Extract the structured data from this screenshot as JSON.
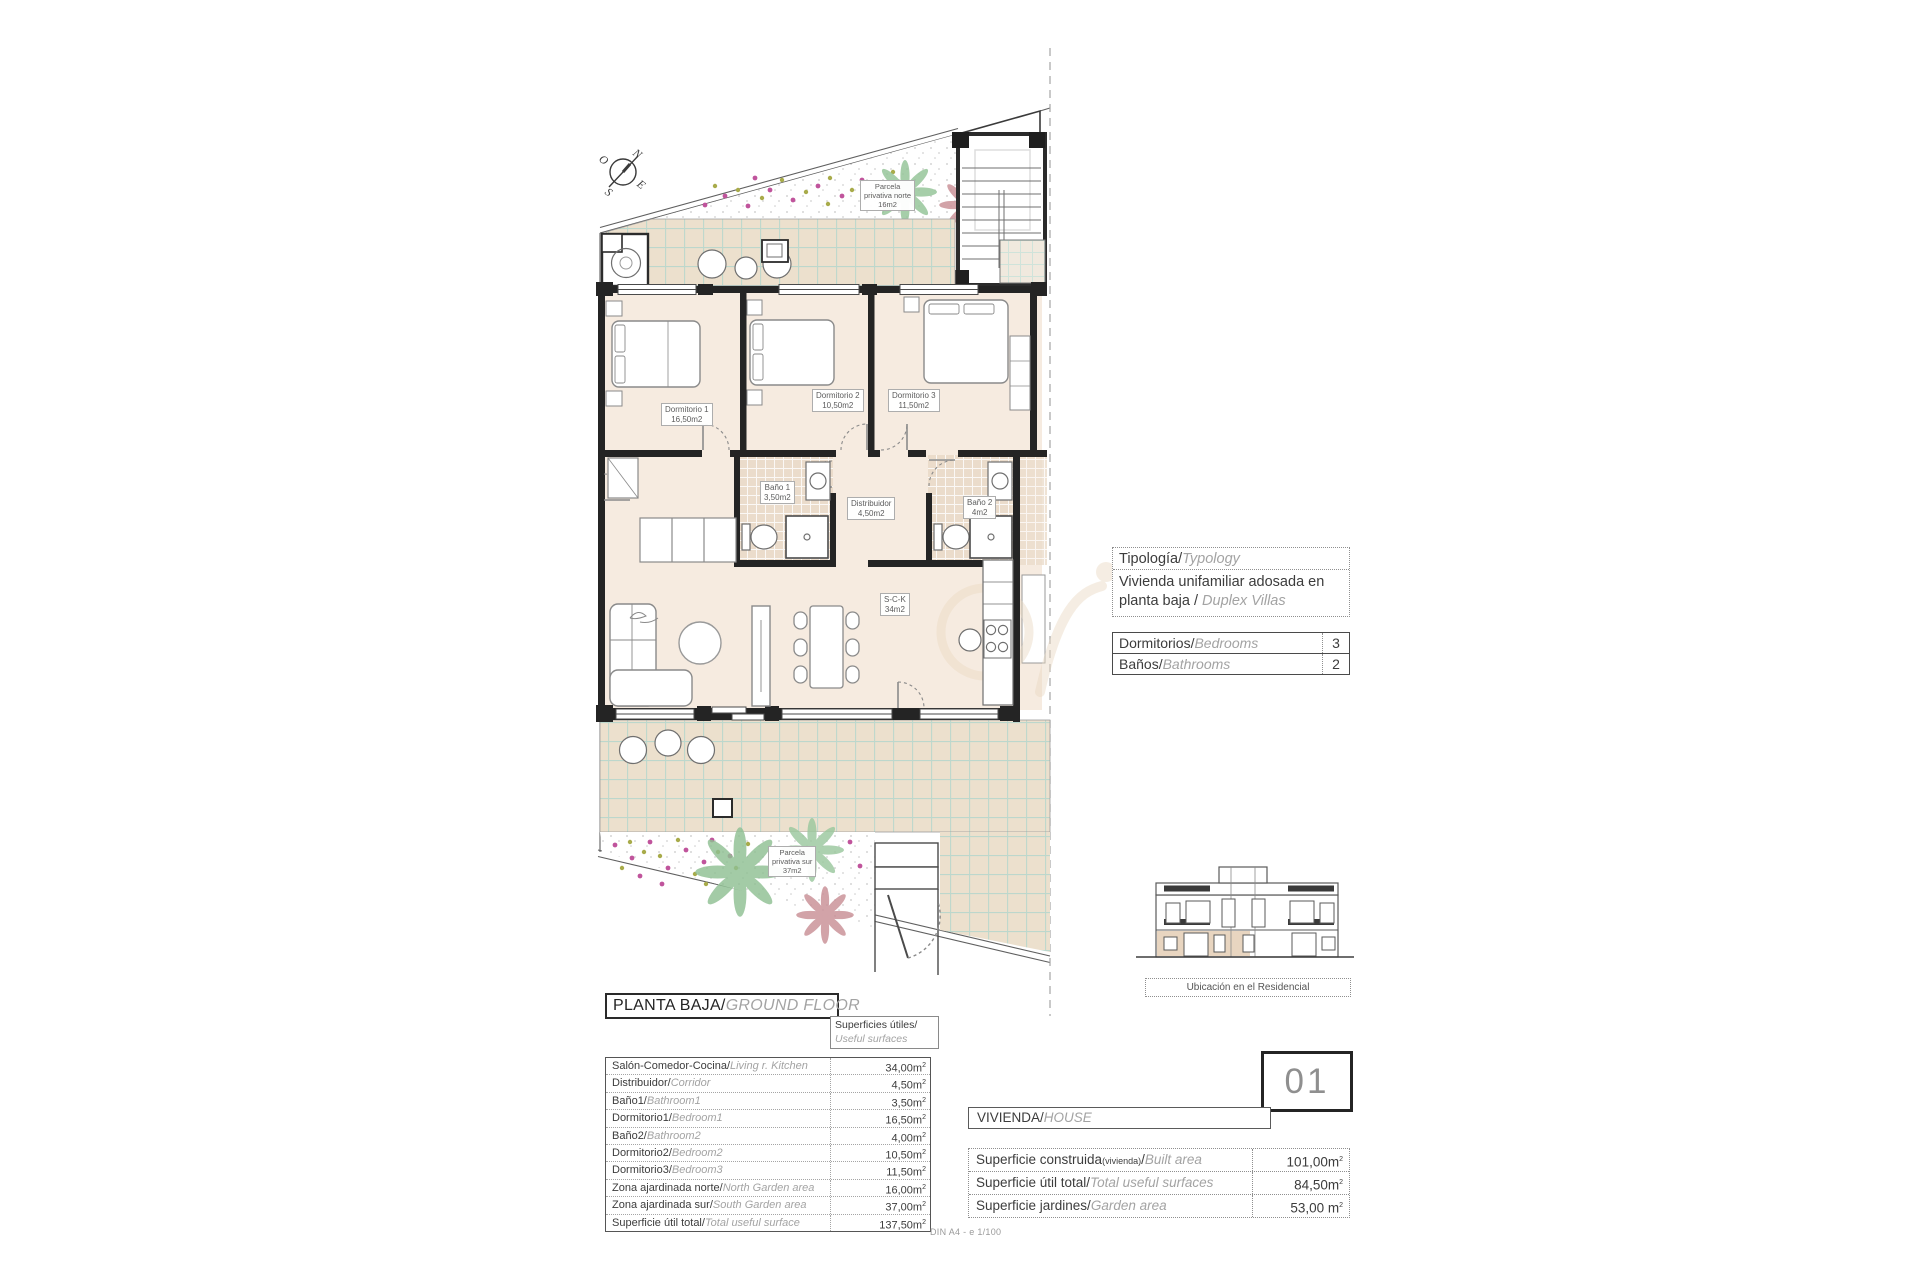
{
  "page": {
    "scale_note": "DIN A4 - e 1/100"
  },
  "compass": {
    "n": "N",
    "e": "E",
    "s": "S",
    "w": "O"
  },
  "plan": {
    "garden_north": {
      "l1": "Parcela",
      "l2": "privativa norte",
      "l3": "16m2"
    },
    "garden_south": {
      "l1": "Parcela",
      "l2": "privativa sur",
      "l3": "37m2"
    },
    "rooms": {
      "dormitorio1": {
        "name": "Dormitorio 1",
        "area": "16,50m2"
      },
      "dormitorio2": {
        "name": "Dormitorio 2",
        "area": "10,50m2"
      },
      "dormitorio3": {
        "name": "Dormitorio 3",
        "area": "11,50m2"
      },
      "bano1": {
        "name": "Baño 1",
        "area": "3,50m2"
      },
      "distribuidor": {
        "name": "Distribuidor",
        "area": "4,50m2"
      },
      "bano2": {
        "name": "Baño 2",
        "area": "4m2"
      },
      "sck": {
        "name": "S-C-K",
        "area": "34m2"
      }
    }
  },
  "typology": {
    "title_es": "Tipología/",
    "title_en": "Typology",
    "body_es": "Vivienda unifamiliar adosada en planta baja / ",
    "body_en": "Duplex Villas"
  },
  "counts": {
    "rows": [
      {
        "es": "Dormitorios/",
        "en": "Bedrooms",
        "value": "3"
      },
      {
        "es": "Baños/",
        "en": "Bathrooms",
        "value": "2"
      }
    ]
  },
  "location": {
    "caption": "Ubicación en el Residencial"
  },
  "floor_header": {
    "es": "PLANTA BAJA/",
    "en": "GROUND FLOOR"
  },
  "surfaces_header": {
    "es": "Superficies útiles/",
    "en": "Useful surfaces"
  },
  "useful_surfaces": {
    "rows": [
      {
        "es": "Salón-Comedor-Cocina/",
        "en": "Living r. Kitchen",
        "value": "34,00m",
        "sup": "2"
      },
      {
        "es": "Distribuidor/",
        "en": "Corridor",
        "value": "4,50m",
        "sup": "2"
      },
      {
        "es": "Baño1/",
        "en": "Bathroom1",
        "value": "3,50m",
        "sup": "2"
      },
      {
        "es": "Dormitorio1/",
        "en": "Bedroom1",
        "value": "16,50m",
        "sup": "2"
      },
      {
        "es": "Baño2/",
        "en": "Bathroom2",
        "value": "4,00m",
        "sup": "2"
      },
      {
        "es": "Dormitorio2/",
        "en": "Bedroom2",
        "value": "10,50m",
        "sup": "2"
      },
      {
        "es": "Dormitorio3/",
        "en": "Bedroom3",
        "value": "11,50m",
        "sup": "2"
      },
      {
        "es": "Zona ajardinada norte/",
        "en": "North Garden area",
        "value": "16,00m",
        "sup": "2"
      },
      {
        "es": "Zona ajardinada sur/",
        "en": "South Garden area",
        "value": "37,00m",
        "sup": "2"
      },
      {
        "es": "Superficie útil total/",
        "en": "Total useful surface",
        "value": "137,50m",
        "sup": "2"
      }
    ]
  },
  "unit": {
    "number": "01",
    "label_es": "VIVIENDA/",
    "label_en": "HOUSE"
  },
  "unit_surfaces": {
    "rows": [
      {
        "es": "Superficie construida",
        "small": "(vivienda)",
        "slash": "/",
        "en": "Built area",
        "value": "101,00m",
        "sup": "2"
      },
      {
        "es": "Superficie útil total/",
        "small": "",
        "slash": "",
        "en": "Total useful surfaces",
        "value": "84,50m",
        "sup": "2"
      },
      {
        "es": "Superficie jardines/",
        "small": "",
        "slash": "",
        "en": "Garden area",
        "value": "53,00 m",
        "sup": "2"
      }
    ]
  }
}
